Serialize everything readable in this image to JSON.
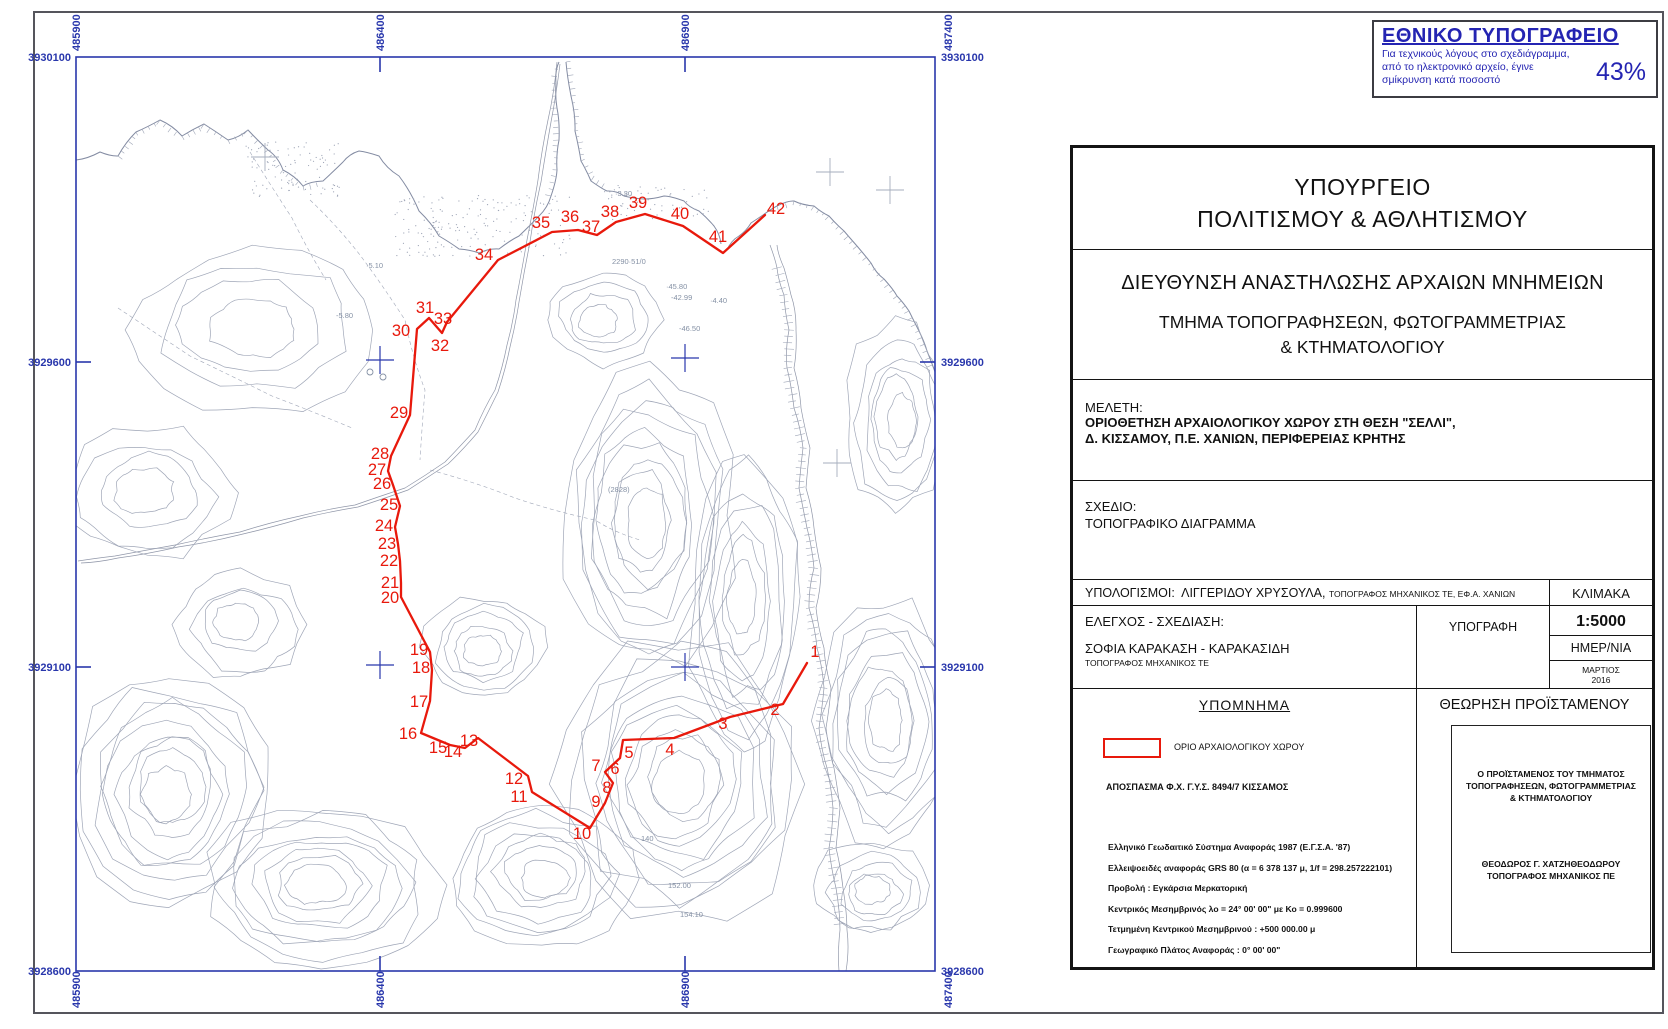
{
  "colors": {
    "frame_blue": "#2937ac",
    "label_blue": "#2937ac",
    "boundary_red": "#e8190c",
    "topo_gray": "#8e96aa",
    "coast_gray": "#6d7792",
    "road_gray": "#7c8499",
    "cross_gray": "#a6adbd",
    "spot_gray": "#8591a5"
  },
  "stamp": {
    "title": "ΕΘΝΙΚΟ ΤΥΠΟΓΡΑΦΕΙΟ",
    "line1": "Για τεχνικούς λόγους στο σχεδιάγραμμα,",
    "line2": "από το ηλεκτρονικό αρχείο, έγινε",
    "line3": "σμίκρυνση κατά ποσοστό",
    "percent": "43%"
  },
  "titleblock": {
    "ministry_line1": "ΥΠΟΥΡΓΕΙΟ",
    "ministry_line2": "ΠΟΛΙΤΙΣΜΟΥ & ΑΘΛΗΤΙΣΜΟΥ",
    "directorate": "ΔΙΕΥΘΥΝΣΗ ΑΝΑΣΤΗΛΩΣΗΣ ΑΡΧΑΙΩΝ ΜΝΗΜΕΙΩΝ",
    "department_line1": "ΤΜΗΜΑ  ΤΟΠΟΓΡΑΦΗΣΕΩΝ, ΦΩΤΟΓΡΑΜΜΕΤΡΙΑΣ",
    "department_line2": "& ΚΤΗΜΑΤΟΛΟΓΙΟΥ",
    "study_label": "ΜΕΛΕΤΗ:",
    "study_line1": "ΟΡΙΟΘΕΤΗΣΗ ΑΡΧΑΙΟΛΟΓΙΚΟΥ ΧΩΡΟΥ ΣΤΗ ΘΕΣΗ \"ΣΕΛΛΙ\",",
    "study_line2": "Δ. ΚΙΣΣΑΜΟΥ, Π.Ε. ΧΑΝΙΩΝ, ΠΕΡΙΦΕΡΕΙΑΣ ΚΡΗΤΗΣ",
    "drawing_label": "ΣΧΕΔΙΟ:",
    "drawing_value": "ΤΟΠΟΓΡΑΦΙΚΟ ΔΙΑΓΡΑΜΜΑ",
    "calc_label": "ΥΠΟΛΟΓΙΣΜΟΙ:",
    "calc_name": "ΛΙΓΓΕΡΙΔΟΥ ΧΡΥΣΟΥΛΑ,",
    "calc_title": "ΤΟΠΟΓΡΑΦΟΣ ΜΗΧΑΝΙΚΟΣ ΤΕ, ΕΦ.Α. ΧΑΝΙΩΝ",
    "scale_label": "ΚΛΙΜΑΚΑ",
    "scale_value": "1:5000",
    "check_label": "ΕΛΕΓΧΟΣ - ΣΧΕΔΙΑΣΗ:",
    "check_name": "ΣΟΦΙΑ ΚΑΡΑΚΑΣΗ - ΚΑΡΑΚΑΣΙΔΗ",
    "check_title": "ΤΟΠΟΓΡΑΦΟΣ ΜΗΧΑΝΙΚΟΣ ΤΕ",
    "signature_label": "ΥΠΟΓΡΑΦΗ",
    "date_label": "ΗΜΕΡ/ΝΙΑ",
    "date_value_line1": "ΜΑΡΤΙΟΣ",
    "date_value_line2": "2016",
    "legend_title": "ΥΠΟΜΝΗΜΑ",
    "legend_item": "ΟΡΙΟ ΑΡΧΑΙΟΛΟΓΙΚΟΥ ΧΩΡΟΥ",
    "excerpt": "ΑΠΟΣΠΑΣΜΑ Φ.Χ. Γ.Υ.Σ.  8494/7 ΚΙΣΣΑΜΟΣ",
    "geodetic_lines": [
      "Ελληνικό Γεωδαιτικό Σύστημα Αναφοράς 1987 (Ε.Γ.Σ.Α. '87)",
      "Ελλειψοειδές αναφοράς GRS 80 (α = 6 378 137 μ, 1/f = 298.257222101)",
      "Προβολή : Εγκάρσια Μερκατορική",
      "Κεντρικός Μεσημβρινός λο = 24° 00' 00\" με Κο = 0.999600",
      "Τετμημένη Κεντρικού Μεσημβρινού : +500 000.00 μ",
      "Γεωγραφικό Πλάτος Αναφοράς : 0° 00' 00\""
    ],
    "approval_title": "ΘΕΩΡΗΣΗ ΠΡΟΪΣΤΑΜΕΝΟΥ",
    "approval_head_line1": "Ο ΠΡΟΪΣΤΑΜΕΝΟΣ ΤΟΥ ΤΜΗΜΑΤΟΣ",
    "approval_head_line2": "ΤΟΠΟΓΡΑΦΗΣΕΩΝ, ΦΩΤΟΓΡΑΜΜΕΤΡΙΑΣ",
    "approval_head_line3": "& ΚΤΗΜΑΤΟΛΟΓΙΟΥ",
    "approval_name": "ΘΕΟΔΩΡΟΣ Γ. ΧΑΤΖΗΘΕΟΔΩΡΟΥ",
    "approval_name_title": "ΤΟΠΟΓΡΑΦΟΣ ΜΗΧΑΝΙΚΟΣ ΠΕ"
  },
  "map": {
    "frame": {
      "x": 76,
      "y": 57,
      "w": 859,
      "h": 914
    },
    "tick_len": 15,
    "easting_labels": [
      {
        "text": "485900",
        "x": 76
      },
      {
        "text": "486400",
        "x": 380
      },
      {
        "text": "486900",
        "x": 685
      },
      {
        "text": "487400",
        "x": 948
      }
    ],
    "easting_ticks": [
      380,
      685
    ],
    "northing_labels": [
      {
        "text": "3930100",
        "y": 57
      },
      {
        "text": "3929600",
        "y": 362
      },
      {
        "text": "3929100",
        "y": 667
      },
      {
        "text": "3928600",
        "y": 971
      }
    ],
    "northing_ticks": [
      362,
      667
    ],
    "crosses_blue": [
      [
        380,
        360
      ],
      [
        685,
        358
      ],
      [
        380,
        665
      ],
      [
        685,
        667
      ]
    ],
    "crosses_gray": [
      [
        265,
        157
      ],
      [
        830,
        172
      ],
      [
        890,
        190
      ],
      [
        837,
        463
      ]
    ],
    "circle_symbols": [
      [
        370,
        372
      ],
      [
        383,
        377
      ]
    ],
    "spot_texts": [
      {
        "t": "·3.30",
        "x": 615,
        "y": 196
      },
      {
        "t": "2290·51/0",
        "x": 612,
        "y": 264
      },
      {
        "t": "·45.80",
        "x": 666,
        "y": 289
      },
      {
        "t": "-42.99",
        "x": 671,
        "y": 300
      },
      {
        "t": "-46.50",
        "x": 679,
        "y": 331
      },
      {
        "t": "·4.40",
        "x": 710,
        "y": 303
      },
      {
        "t": "(2828)",
        "x": 608,
        "y": 492
      },
      {
        "t": "·5.10",
        "x": 366,
        "y": 268
      },
      {
        "t": "-5.80",
        "x": 336,
        "y": 318
      },
      {
        "t": "140",
        "x": 641,
        "y": 841
      },
      {
        "t": "152.00",
        "x": 668,
        "y": 888
      },
      {
        "t": "154.10",
        "x": 680,
        "y": 917
      }
    ],
    "boundary": {
      "legend": "ΟΡΙΟ ΑΡΧΑΙΟΛΟΓΙΚΟΥ ΧΩΡΟΥ",
      "points": [
        [
          1,
          807,
          663,
          815,
          652
        ],
        [
          2,
          783,
          704,
          775,
          710
        ],
        [
          3,
          730,
          717,
          723,
          724
        ],
        [
          4,
          674,
          738,
          670,
          750
        ],
        [
          5,
          623,
          740,
          629,
          753
        ],
        [
          6,
          620,
          758,
          615,
          769
        ],
        [
          7,
          605,
          772,
          596,
          766
        ],
        [
          8,
          613,
          783,
          607,
          788
        ],
        [
          9,
          605,
          803,
          596,
          802
        ],
        [
          10,
          590,
          828,
          582,
          834
        ],
        [
          11,
          532,
          792,
          519,
          797
        ],
        [
          12,
          528,
          776,
          514,
          779
        ],
        [
          13,
          478,
          738,
          469,
          741
        ],
        [
          14,
          465,
          748,
          453,
          752
        ],
        [
          15,
          450,
          745,
          438,
          748
        ],
        [
          16,
          421,
          733,
          408,
          734
        ],
        [
          17,
          430,
          701,
          419,
          702
        ],
        [
          18,
          432,
          670,
          421,
          668
        ],
        [
          19,
          430,
          652,
          419,
          650
        ],
        [
          20,
          401,
          597,
          390,
          598
        ],
        [
          21,
          401,
          583,
          390,
          583
        ],
        [
          22,
          400,
          561,
          389,
          561
        ],
        [
          23,
          398,
          544,
          387,
          544
        ],
        [
          24,
          395,
          527,
          384,
          526
        ],
        [
          25,
          400,
          506,
          389,
          505
        ],
        [
          26,
          393,
          485,
          382,
          484
        ],
        [
          27,
          388,
          471,
          377,
          470
        ],
        [
          28,
          391,
          456,
          380,
          454
        ],
        [
          29,
          410,
          415,
          399,
          413
        ],
        [
          30,
          417,
          329,
          401,
          331
        ],
        [
          31,
          429,
          318,
          425,
          308
        ],
        [
          32,
          442,
          333,
          440,
          346
        ],
        [
          33,
          447,
          322,
          443,
          319
        ],
        [
          34,
          498,
          260,
          484,
          255
        ],
        [
          35,
          552,
          232,
          541,
          223
        ],
        [
          36,
          578,
          230,
          570,
          217
        ],
        [
          37,
          597,
          235,
          591,
          227
        ],
        [
          38,
          616,
          222,
          610,
          212
        ],
        [
          39,
          645,
          214,
          638,
          203
        ],
        [
          40,
          683,
          226,
          680,
          214
        ],
        [
          41,
          723,
          253,
          718,
          237
        ],
        [
          42,
          765,
          215,
          776,
          209
        ]
      ]
    }
  }
}
